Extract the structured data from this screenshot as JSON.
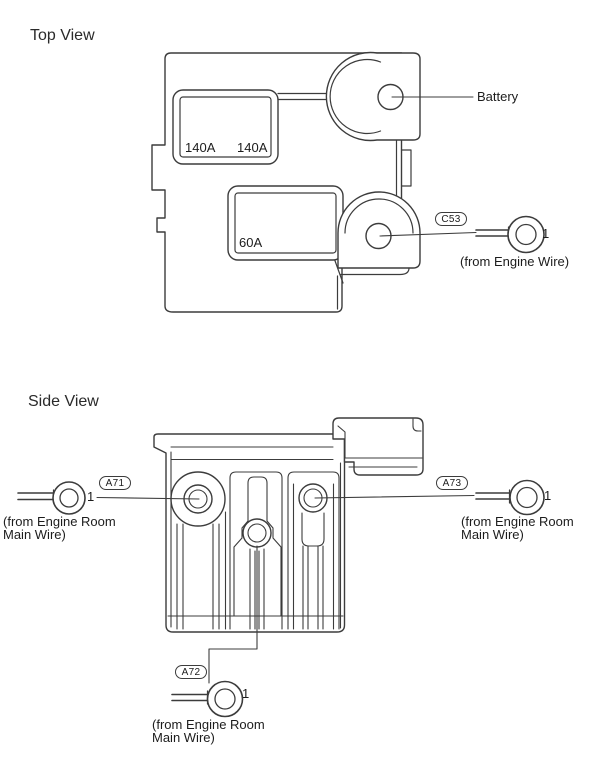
{
  "colors": {
    "background": "#ffffff",
    "line": "#3c3c3c",
    "text": "#1c1c1c"
  },
  "top_view": {
    "title": "Top View",
    "fuse_ratings": {
      "upper_left": "140A",
      "upper_right": "140A",
      "lower": "60A"
    },
    "battery_label": "Battery",
    "c53": {
      "code": "C53",
      "pin": "1",
      "source": "(from Engine Wire)"
    }
  },
  "side_view": {
    "title": "Side View",
    "a71": {
      "code": "A71",
      "pin": "1",
      "source_line1": "(from Engine Room",
      "source_line2": "Main Wire)"
    },
    "a72": {
      "code": "A72",
      "pin": "1",
      "source_line1": "(from Engine Room",
      "source_line2": "Main Wire)"
    },
    "a73": {
      "code": "A73",
      "pin": "1",
      "source_line1": "(from Engine Room",
      "source_line2": "Main Wire)"
    }
  }
}
